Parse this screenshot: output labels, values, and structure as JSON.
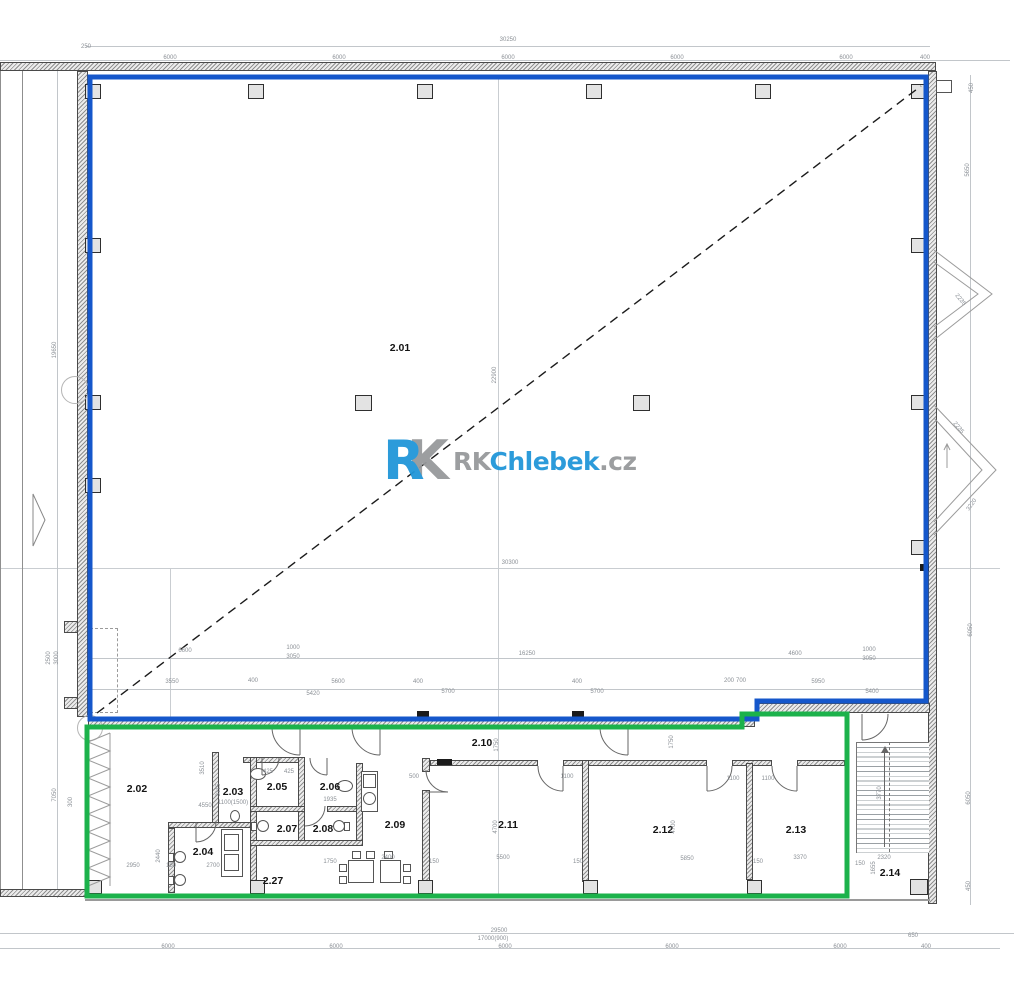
{
  "title": "Floor plan – 2nd floor units",
  "logo": {
    "mark_r": "R",
    "mark_k": "K",
    "rk": "RK",
    "name": "Chlebek",
    "tld": ".cz"
  },
  "colors": {
    "unit_blue": "#1557cb",
    "unit_green": "#1cb24b",
    "logo_blue": "#2196d9",
    "logo_gray": "#97999b",
    "wall_dark": "#4a4a4a",
    "dim_text": "#8b9096"
  },
  "rooms": [
    {
      "id": "2.01",
      "x": 400,
      "y": 348
    },
    {
      "id": "2.02",
      "x": 137,
      "y": 789
    },
    {
      "id": "2.03",
      "x": 233,
      "y": 792
    },
    {
      "id": "2.04",
      "x": 203,
      "y": 852
    },
    {
      "id": "2.05",
      "x": 277,
      "y": 787
    },
    {
      "id": "2.06",
      "x": 330,
      "y": 787
    },
    {
      "id": "2.07",
      "x": 287,
      "y": 829
    },
    {
      "id": "2.08",
      "x": 323,
      "y": 829
    },
    {
      "id": "2.09",
      "x": 395,
      "y": 825
    },
    {
      "id": "2.10",
      "x": 482,
      "y": 743
    },
    {
      "id": "2.11",
      "x": 508,
      "y": 825
    },
    {
      "id": "2.12",
      "x": 663,
      "y": 830
    },
    {
      "id": "2.13",
      "x": 796,
      "y": 830
    },
    {
      "id": "2.14",
      "x": 890,
      "y": 873
    },
    {
      "id": "2.27",
      "x": 273,
      "y": 881
    }
  ],
  "dimensions": [
    {
      "t": "250",
      "x": 86,
      "y": 47
    },
    {
      "t": "30250",
      "x": 508,
      "y": 40
    },
    {
      "t": "6000",
      "x": 170,
      "y": 58
    },
    {
      "t": "6000",
      "x": 339,
      "y": 58
    },
    {
      "t": "6000",
      "x": 508,
      "y": 58
    },
    {
      "t": "6000",
      "x": 677,
      "y": 58
    },
    {
      "t": "6000",
      "x": 846,
      "y": 58
    },
    {
      "t": "400",
      "x": 925,
      "y": 58
    },
    {
      "t": "450",
      "x": 972,
      "y": 88,
      "r": -90
    },
    {
      "t": "5650",
      "x": 968,
      "y": 170,
      "r": -90
    },
    {
      "t": "2235",
      "x": 960,
      "y": 300,
      "r": 50
    },
    {
      "t": "2235",
      "x": 958,
      "y": 428,
      "r": 50
    },
    {
      "t": "3220",
      "x": 972,
      "y": 505,
      "r": -55
    },
    {
      "t": "6050",
      "x": 971,
      "y": 630,
      "r": -90
    },
    {
      "t": "6050",
      "x": 969,
      "y": 798,
      "r": -90
    },
    {
      "t": "450",
      "x": 969,
      "y": 886,
      "r": -90
    },
    {
      "t": "19650",
      "x": 55,
      "y": 350,
      "r": -90
    },
    {
      "t": "2500",
      "x": 49,
      "y": 658,
      "r": -90
    },
    {
      "t": "3000",
      "x": 57,
      "y": 658,
      "r": -90
    },
    {
      "t": "7050",
      "x": 55,
      "y": 795,
      "r": -90
    },
    {
      "t": "300",
      "x": 71,
      "y": 802,
      "r": -90
    },
    {
      "t": "22900",
      "x": 495,
      "y": 375,
      "r": -90
    },
    {
      "t": "30300",
      "x": 510,
      "y": 563
    },
    {
      "t": "6600",
      "x": 185,
      "y": 651
    },
    {
      "t": "1000",
      "x": 293,
      "y": 648
    },
    {
      "t": "3050",
      "x": 293,
      "y": 657
    },
    {
      "t": "16250",
      "x": 527,
      "y": 654
    },
    {
      "t": "4600",
      "x": 795,
      "y": 654
    },
    {
      "t": "1000",
      "x": 869,
      "y": 650
    },
    {
      "t": "3050",
      "x": 869,
      "y": 659
    },
    {
      "t": "3550",
      "x": 172,
      "y": 682
    },
    {
      "t": "400",
      "x": 253,
      "y": 681
    },
    {
      "t": "5600",
      "x": 338,
      "y": 682
    },
    {
      "t": "5420",
      "x": 313,
      "y": 694
    },
    {
      "t": "400",
      "x": 418,
      "y": 682
    },
    {
      "t": "5700",
      "x": 448,
      "y": 692
    },
    {
      "t": "400",
      "x": 577,
      "y": 682
    },
    {
      "t": "5700",
      "x": 597,
      "y": 692
    },
    {
      "t": "200",
      "x": 729,
      "y": 681
    },
    {
      "t": "700",
      "x": 741,
      "y": 681
    },
    {
      "t": "5950",
      "x": 818,
      "y": 682
    },
    {
      "t": "5400",
      "x": 872,
      "y": 692
    },
    {
      "t": "3510",
      "x": 203,
      "y": 768,
      "r": -90
    },
    {
      "t": "3115",
      "x": 219,
      "y": 790,
      "r": -90
    },
    {
      "t": "4550",
      "x": 205,
      "y": 806
    },
    {
      "t": "2950",
      "x": 133,
      "y": 866
    },
    {
      "t": "2440",
      "x": 159,
      "y": 856,
      "r": -90
    },
    {
      "t": "150",
      "x": 171,
      "y": 866
    },
    {
      "t": "2700",
      "x": 213,
      "y": 866
    },
    {
      "t": "1100(1500)",
      "x": 233,
      "y": 803
    },
    {
      "t": "425",
      "x": 268,
      "y": 772
    },
    {
      "t": "425",
      "x": 289,
      "y": 772
    },
    {
      "t": "1935",
      "x": 330,
      "y": 800
    },
    {
      "t": "1750",
      "x": 330,
      "y": 862
    },
    {
      "t": "2400",
      "x": 388,
      "y": 858
    },
    {
      "t": "500",
      "x": 414,
      "y": 777
    },
    {
      "t": "1750",
      "x": 497,
      "y": 745,
      "r": -90
    },
    {
      "t": "1100",
      "x": 567,
      "y": 777
    },
    {
      "t": "4700",
      "x": 496,
      "y": 827,
      "r": -90
    },
    {
      "t": "5500",
      "x": 503,
      "y": 858
    },
    {
      "t": "150",
      "x": 434,
      "y": 862
    },
    {
      "t": "1750",
      "x": 672,
      "y": 742,
      "r": -90
    },
    {
      "t": "4700",
      "x": 674,
      "y": 827,
      "r": -90
    },
    {
      "t": "5850",
      "x": 687,
      "y": 859
    },
    {
      "t": "150",
      "x": 578,
      "y": 862
    },
    {
      "t": "1100",
      "x": 733,
      "y": 779
    },
    {
      "t": "1100",
      "x": 768,
      "y": 779
    },
    {
      "t": "3370",
      "x": 800,
      "y": 858
    },
    {
      "t": "150",
      "x": 758,
      "y": 862
    },
    {
      "t": "3770",
      "x": 880,
      "y": 793,
      "r": -90
    },
    {
      "t": "2320",
      "x": 884,
      "y": 858
    },
    {
      "t": "1655",
      "x": 874,
      "y": 868,
      "r": -90
    },
    {
      "t": "150",
      "x": 860,
      "y": 864
    },
    {
      "t": "6000",
      "x": 168,
      "y": 947
    },
    {
      "t": "6000",
      "x": 336,
      "y": 947
    },
    {
      "t": "6000",
      "x": 505,
      "y": 947
    },
    {
      "t": "6000",
      "x": 672,
      "y": 947
    },
    {
      "t": "6000",
      "x": 840,
      "y": 947
    },
    {
      "t": "650",
      "x": 913,
      "y": 936
    },
    {
      "t": "400",
      "x": 926,
      "y": 947
    },
    {
      "t": "29500",
      "x": 499,
      "y": 931
    },
    {
      "t": "17000(900)",
      "x": 493,
      "y": 939
    }
  ]
}
